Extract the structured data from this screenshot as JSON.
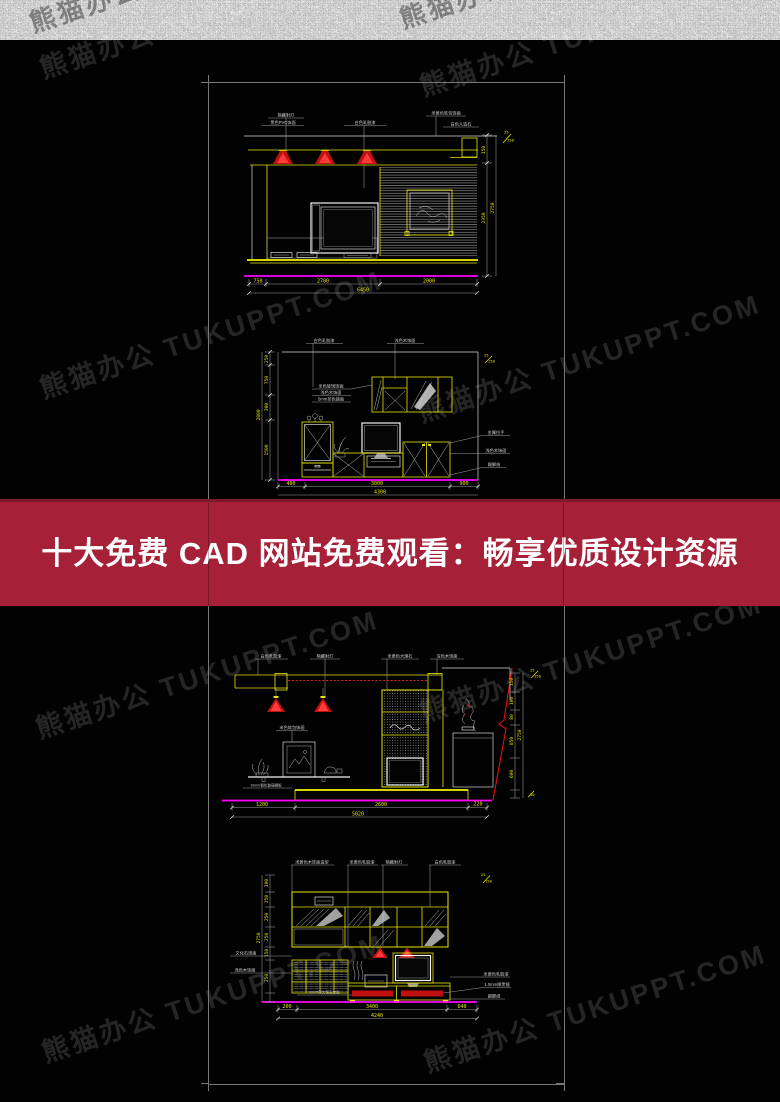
{
  "watermark": {
    "text": "熊猫办公 TUKUPPT.COM"
  },
  "banner": {
    "title": "十大免费 CAD 网站免费观看：畅享优质设计资源",
    "bg": "#A62138",
    "text_color": "#FFFFFF"
  },
  "colors": {
    "cad_yellow": "#E6E600",
    "cad_magenta": "#FF00FF",
    "cad_red": "#E01212",
    "cad_white": "#D8D8D8",
    "sheet_border": "#787878"
  },
  "d1": {
    "labels": [
      "暗藏射灯",
      "黑色PVC饰面",
      "白色乳胶漆",
      "米黄色软包饰面",
      "白色人造石"
    ],
    "dims_bottom": [
      "750",
      "2700",
      "2000"
    ],
    "dim_total": "6450",
    "dims_right": [
      "150",
      "2350"
    ],
    "dim_right_total": "2750",
    "note": [
      "25",
      "150"
    ]
  },
  "d2": {
    "labels_top": [
      "白色乳胶漆",
      "浅色木饰面"
    ],
    "labels_mid": [
      "米色玻璃饰面",
      "浅色木饰面",
      "5mm茶色镜面"
    ],
    "labels_right": [
      "金属拉手",
      "浅色木饰面",
      "踢脚线"
    ],
    "dims_left": [
      "250",
      "750",
      "300",
      "1500"
    ],
    "dim_left_total": "2800",
    "dims_bottom": [
      "400",
      "3000",
      "900"
    ],
    "dim_total": "4300",
    "note": [
      "25",
      "150"
    ]
  },
  "d3": {
    "labels_top": [
      "白色乳胶漆",
      "暗藏射灯",
      "米黄色大理石",
      "深色木饰面"
    ],
    "label_frame": "米色软包饰面",
    "label_shelf": "10mm钢化玻璃搁板",
    "dims_bottom": [
      "1200",
      "2600",
      "220"
    ],
    "dim_total": "5020",
    "dims_right": [
      "150",
      "100",
      "80",
      "850",
      "600"
    ],
    "dim_right_total": "2750",
    "note": [
      "25",
      "150"
    ],
    "note_low": "50"
  },
  "d4": {
    "labels_top": [
      "浅黄色木饰面造型",
      "米黄色乳胶漆",
      "暗藏射灯",
      "白色乳胶漆"
    ],
    "labels_left": [
      "文化石饰面",
      "浅色木饰面"
    ],
    "label_counter": "20mm厚大理石台面",
    "labels_right": [
      "米黄色乳胶漆",
      "1.0mm厚黑镜",
      "踢脚线"
    ],
    "dims_left": [
      "100",
      "250",
      "250",
      "250",
      "150",
      "250"
    ],
    "dim_left_total": "2750",
    "dims_bottom": [
      "200",
      "3400",
      "640"
    ],
    "dim_total": "4240",
    "note": [
      "25",
      "150"
    ]
  }
}
